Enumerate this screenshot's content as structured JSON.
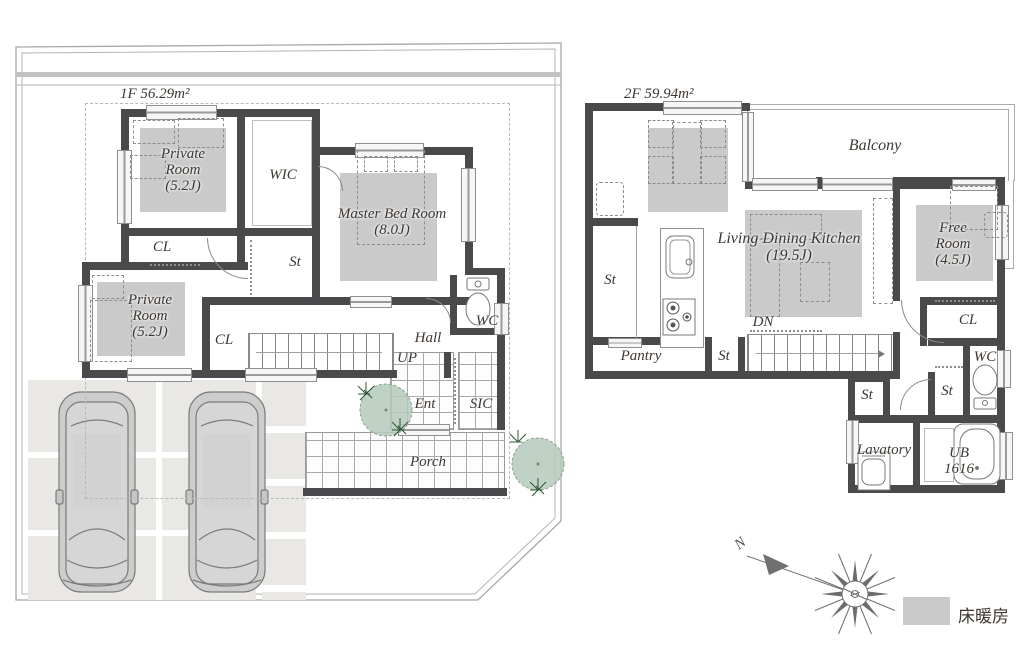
{
  "floor1": {
    "area": "1F 56.29m²",
    "private_room_upper": {
      "name": "Private Room",
      "size": "(5.2J)"
    },
    "wic": "WIC",
    "master": {
      "name": "Master Bed Room",
      "size": "(8.0J)"
    },
    "closet_upper": "CL",
    "storage": "St",
    "private_room_lower": {
      "name": "Private Room",
      "size": "(5.2J)"
    },
    "closet_lower": "CL",
    "wc": "WC",
    "hall": "Hall",
    "up": "UP",
    "entrance": "Ent",
    "shoe_closet": "SIC",
    "porch": "Porch"
  },
  "floor2": {
    "area": "2F 59.94m²",
    "balcony": "Balcony",
    "ldk": {
      "name": "Living Dining Kitchen",
      "size": "(19.5J)"
    },
    "free_room": {
      "name": "Free Room",
      "size": "(4.5J)"
    },
    "storage_left": "St",
    "pantry": "Pantry",
    "storage_mid": "St",
    "down": "DN",
    "closet": "CL",
    "wc": "WC",
    "storage_hall": "St",
    "storage_bath": "St",
    "lavatory": "Lavatory",
    "unit_bath": {
      "name": "UB",
      "size": "1616"
    }
  },
  "legend": {
    "floor_heating": "床暖房"
  },
  "compass": {
    "north_label": "N"
  },
  "colors": {
    "wall": "#4a4a4c",
    "heated_floor": "#cacaca",
    "paving": "#e9e8e4",
    "tree_fill": "#b5cabb",
    "tree_spike": "#2d5733",
    "boundary": "#a8a8a8",
    "text": "#3e3833"
  }
}
